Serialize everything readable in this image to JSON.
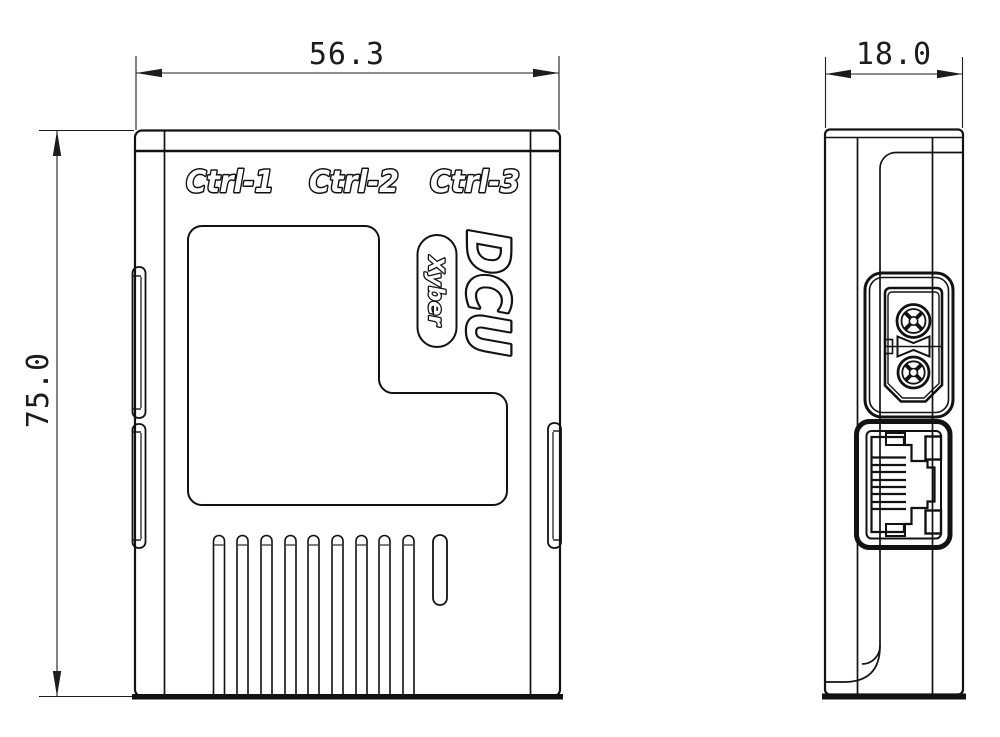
{
  "front_view": {
    "dim_width": "56.3",
    "dim_height": "75.0",
    "port_labels": [
      "Ctrl-1",
      "Ctrl-2",
      "Ctrl-3"
    ],
    "product_name": "DCU",
    "brand": "Xyber",
    "vent_slot_count": 9
  },
  "side_view": {
    "dim_depth": "18.0",
    "power_terminal_count": 2,
    "ethernet_pin_count": 8
  },
  "colors": {
    "line": "#121212",
    "background": "#ffffff"
  }
}
